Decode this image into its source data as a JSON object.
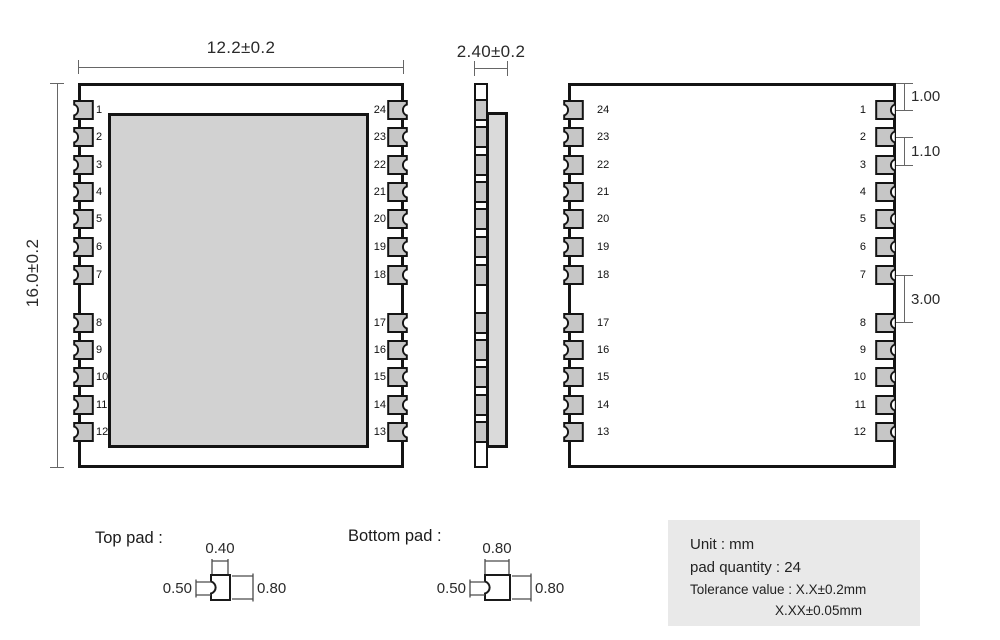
{
  "front_view": {
    "width_dim": "12.2±0.2",
    "height_dim": "16.0±0.2",
    "left_pins": [
      "1",
      "2",
      "3",
      "4",
      "5",
      "6",
      "7",
      "8",
      "9",
      "10",
      "11",
      "12"
    ],
    "right_pins": [
      "24",
      "23",
      "22",
      "21",
      "20",
      "19",
      "18",
      "17",
      "16",
      "15",
      "14",
      "13"
    ]
  },
  "side_view": {
    "width_dim": "2.40±0.2"
  },
  "bottom_view": {
    "left_pins": [
      "24",
      "23",
      "22",
      "21",
      "20",
      "19",
      "18",
      "17",
      "16",
      "15",
      "14",
      "13"
    ],
    "right_pins": [
      "1",
      "2",
      "3",
      "4",
      "5",
      "6",
      "7",
      "8",
      "9",
      "10",
      "11",
      "12"
    ],
    "dim_top_margin": "1.00",
    "dim_pad_pitch": "1.10",
    "dim_mid_gap": "3.00"
  },
  "top_pad": {
    "label": "Top pad :",
    "dim_notch_width": "0.40",
    "dim_notch_height": "0.50",
    "dim_pad_height": "0.80"
  },
  "bottom_pad": {
    "label": "Bottom pad :",
    "dim_pad_width": "0.80",
    "dim_notch_height": "0.50",
    "dim_pad_height": "0.80"
  },
  "info_box": {
    "unit": "Unit : mm",
    "pad_quantity": "pad quantity : 24",
    "tolerance_line1": "Tolerance value : X.X±0.2mm",
    "tolerance_line2": "X.XX±0.05mm"
  },
  "colors": {
    "outline": "#141414",
    "pad_fill": "#c6c6c6",
    "shield_fill": "#d2d2d2",
    "side_shield_fill": "#dadada",
    "dim_line": "#666666",
    "info_bg": "#e9e9e9"
  }
}
